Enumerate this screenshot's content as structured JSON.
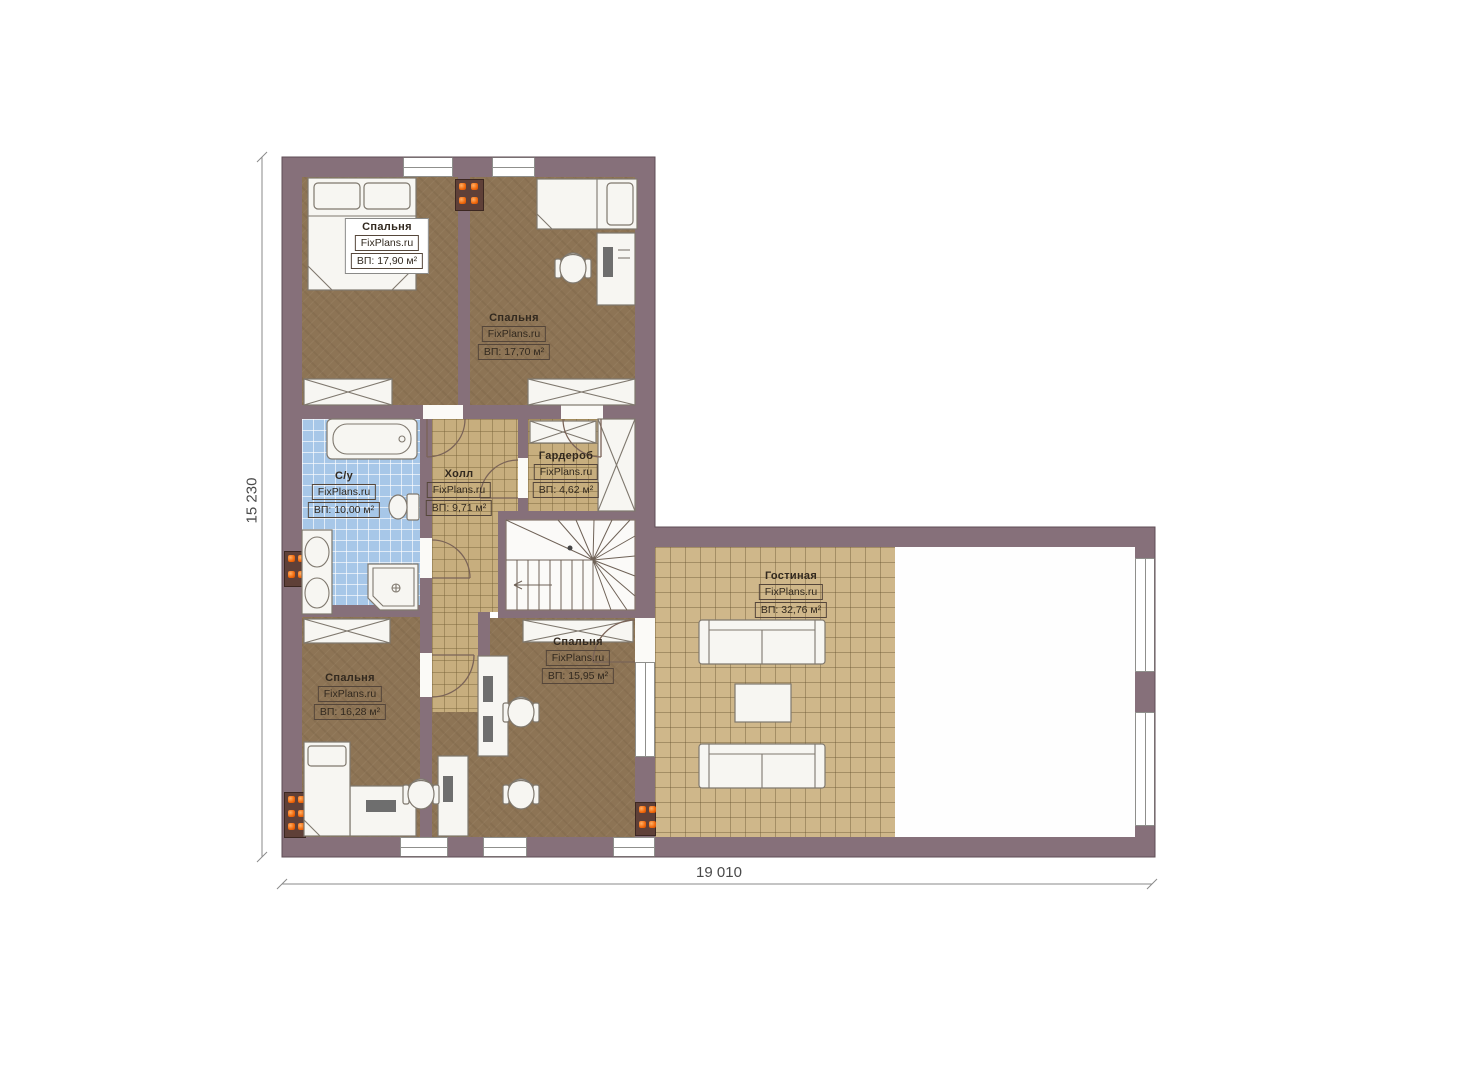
{
  "brand": "FixPlans.ru",
  "dimensions": {
    "horizontal": "19 010",
    "vertical": "15 230"
  },
  "rooms": [
    {
      "id": "bedroom-1",
      "name": "Спальня",
      "area": "ВП: 17,90 м²"
    },
    {
      "id": "bedroom-2",
      "name": "Спальня",
      "area": "ВП: 17,70 м²"
    },
    {
      "id": "bathroom",
      "name": "С/у",
      "area": "ВП: 10,00 м²"
    },
    {
      "id": "hall",
      "name": "Холл",
      "area": "ВП: 9,71 м²"
    },
    {
      "id": "wardrobe",
      "name": "Гардероб",
      "area": "ВП: 4,62 м²"
    },
    {
      "id": "bedroom-3",
      "name": "Спальня",
      "area": "ВП: 15,95 м²"
    },
    {
      "id": "bedroom-4",
      "name": "Спальня",
      "area": "ВП: 16,28 м²"
    },
    {
      "id": "living-room",
      "name": "Гостиная",
      "area": "ВП: 32,76 м²"
    }
  ],
  "colors": {
    "wall": "#86707a",
    "wood_floor": "#8d7455",
    "hall_tile": "#c7ae7e",
    "living_tile": "#cfb78a",
    "bath_tile": "#a7c7e8",
    "radiator": "#f1680b"
  }
}
